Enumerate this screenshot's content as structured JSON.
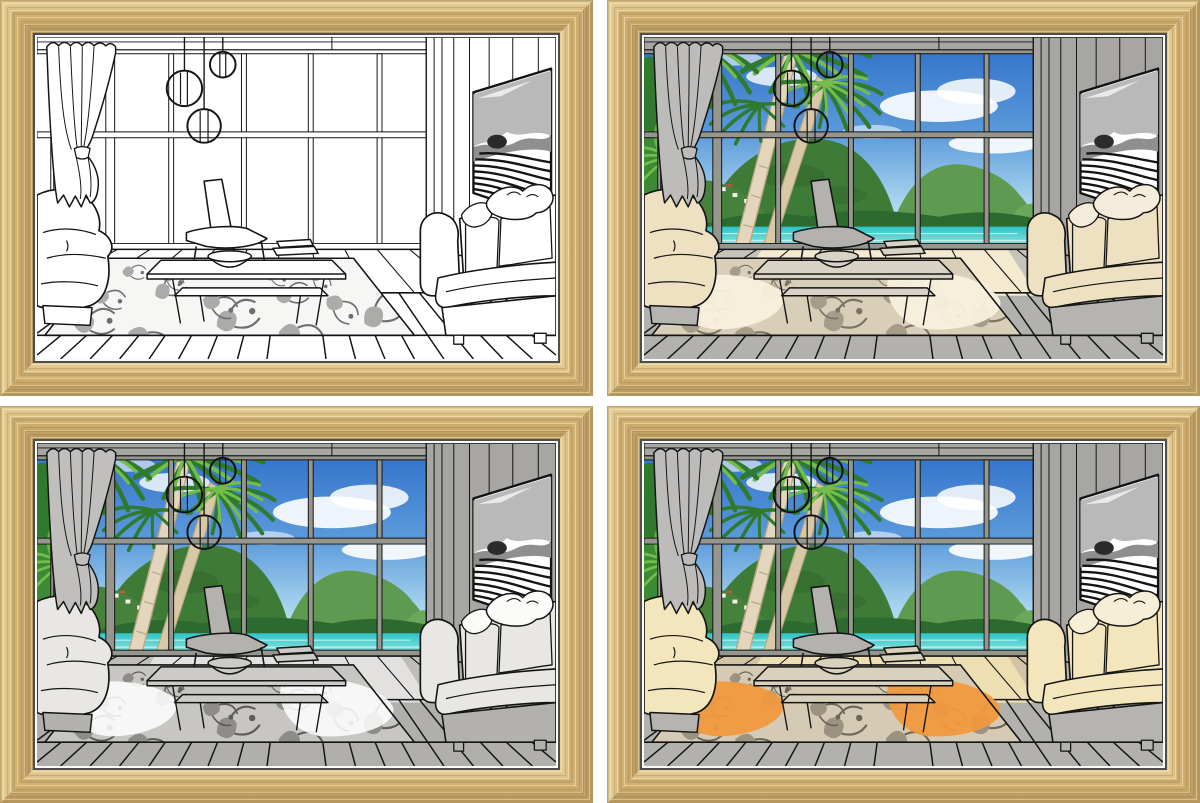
{
  "product_image": {
    "kind": "framed light-up line-art wall picture, four lighting states",
    "background": "#ffffff"
  },
  "panels": [
    {
      "position": "top-left",
      "mode": "sketch",
      "label": "line art picture, light off"
    },
    {
      "position": "top-right",
      "mode": "lit-warm",
      "label": "picture with beach view and warm accent light"
    },
    {
      "position": "bottom-left",
      "mode": "lit-gray",
      "label": "picture with beach view, neutral light"
    },
    {
      "position": "bottom-right",
      "mode": "lit-full",
      "label": "picture with beach view and full warm glow"
    }
  ],
  "palette": {
    "shared": {
      "wood": "#d2b273",
      "wood-light": "#e9d39c",
      "wood-dark": "#b3945a",
      "line": "#141414",
      "sky-top": "#2e6fc9",
      "sky-mid": "#5b9ada",
      "sky-low": "#a9d5ef",
      "sky-horizon": "#d8eef8",
      "cloud": "#ffffff",
      "hill-far": "#5e9a50",
      "hill-main": "#3e7b37",
      "hill-near": "#47823d",
      "hill-shadow": "#2c5a26",
      "shore-green": "#2d6a2f",
      "sea-top": "#2ec4c8",
      "sea-bottom": "#9fe8e2",
      "sea-streak": "#d9f6f2",
      "sand": "#e6d3b8",
      "trunk": "#e3d6bd",
      "trunk-dark": "#b9a884",
      "frond-dark": "#2f7a2c",
      "frond-light": "#74bd4b",
      "tv-gray": "#b9b9b9",
      "tv-mid": "#8f8f8f",
      "tv-dark": "#2b2b2b"
    },
    "modes": {
      "sketch": {
        "view": "none",
        "wall": "#ffffff",
        "mullion": "#ffffff",
        "curtain": "#ffffff",
        "chair": "#ffffff",
        "table": "#ffffff",
        "sofa": "#ffffff",
        "sofa-base": "#ffffff",
        "pillow": "#ffffff",
        "floor": "#ffffff",
        "deck": "#ffffff",
        "rug-base": "#f6f6f4",
        "rug-pat": "#6e6e6e",
        "patch": "rgba(0,0,0,0)",
        "rug-patch": "rgba(0,0,0,0)"
      },
      "lit-warm": {
        "view": "inline",
        "wall": "#a7a6a2",
        "mullion": "#96968f",
        "curtain": "#bdbcba",
        "chair": "#b3b2ae",
        "table": "#d8d3c4",
        "sofa": "#eee1c2",
        "sofa-base": "#b5b4b0",
        "pillow": "#f3ecda",
        "floor": "#b2b1ad",
        "deck": "#c6c3ba",
        "rug-base": "#d9cfb8",
        "rug-pat": "#7a7265",
        "patch": "#f3ead0",
        "rug-patch": "#f7f0dc"
      },
      "lit-gray": {
        "view": "inline",
        "wall": "#a7a6a2",
        "mullion": "#96968f",
        "curtain": "#c0bfbd",
        "chair": "#b3b2ae",
        "table": "#cccbc7",
        "sofa": "#e8e7e3",
        "sofa-base": "#b2b1ad",
        "pillow": "#fbfbf9",
        "floor": "#b0afab",
        "deck": "#bebdb8",
        "rug-base": "#c7c6c2",
        "rug-pat": "#5d5c58",
        "patch": "rgba(255,255,255,0.55)",
        "rug-patch": "rgba(255,255,255,0.9)"
      },
      "lit-full": {
        "view": "inline",
        "wall": "#a7a6a2",
        "mullion": "#96968f",
        "curtain": "#bdbcba",
        "chair": "#b3b2ae",
        "table": "#d8d2bd",
        "sofa": "#f3e6bd",
        "sofa-base": "#b5b4b0",
        "pillow": "#f6eed6",
        "floor": "#b2b1ad",
        "deck": "#d2c3a4",
        "rug-base": "#d5cbb4",
        "rug-pat": "#6d6558",
        "patch": "#eedfb3",
        "rug-patch": "#f0993f"
      }
    }
  }
}
